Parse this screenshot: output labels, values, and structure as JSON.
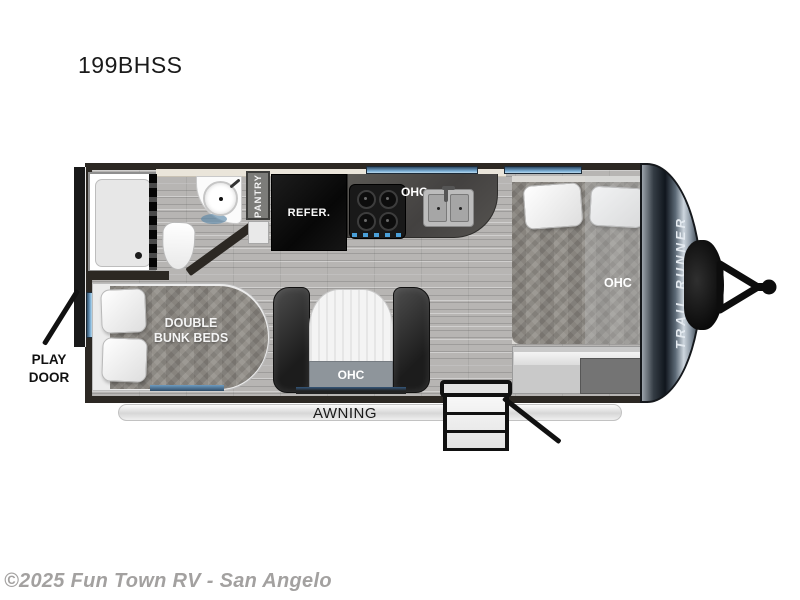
{
  "title": "199BHSS",
  "watermark": "©2025 Fun Town RV - San Angelo",
  "floorplan": {
    "brand": "TRAIL RUNNER",
    "labels": {
      "pantry": "PANTRY",
      "refer": "REFER.",
      "ohc_kitchen": "OHC",
      "ohc_bed": "OHC",
      "ohc_dinette": "OHC",
      "bunks": "DOUBLE\nBUNK BEDS",
      "play_door": "PLAY\nDOOR",
      "awning": "AWNING"
    },
    "colors": {
      "wall": "#2c2823",
      "floor_wood": "#b7b5b3",
      "window_blue": "#6e9cc0",
      "quilt_gray": "#8f8b85",
      "seat_leather": "#2b2b2b",
      "cap_chrome": "#5d6a77",
      "stove_knob_blue": "#4a9fd8"
    }
  }
}
